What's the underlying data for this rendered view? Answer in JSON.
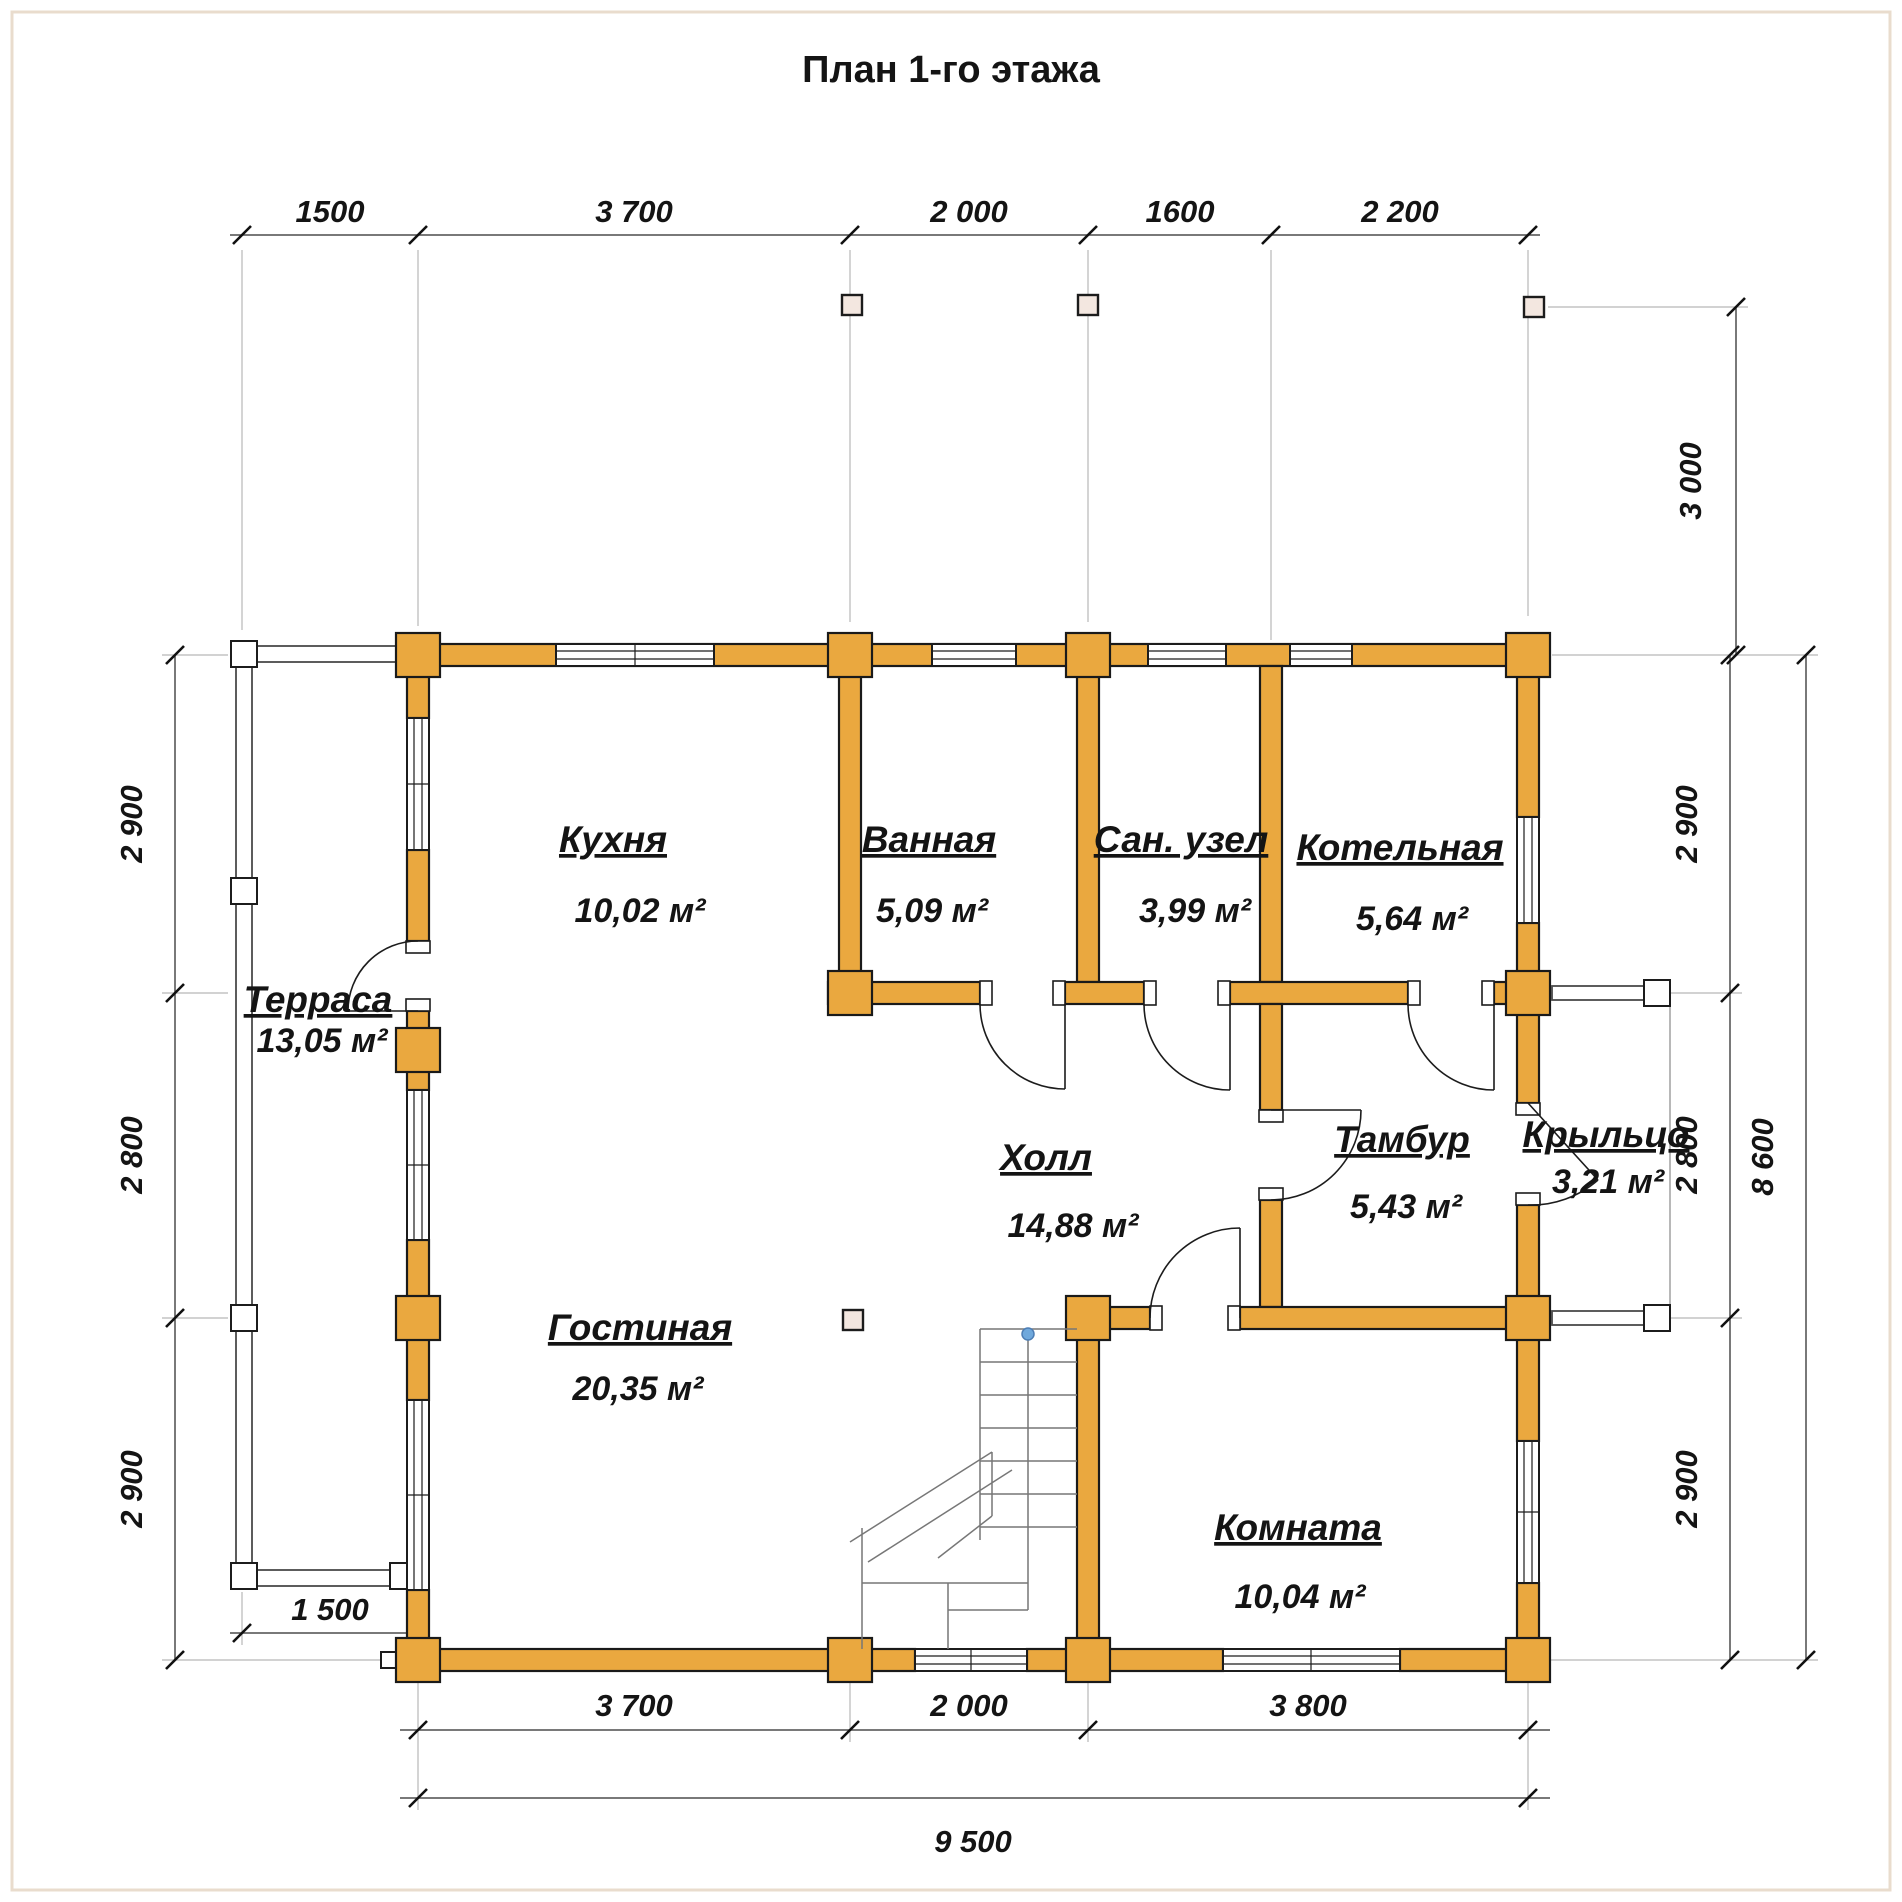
{
  "title": "План 1-го этажа",
  "colors": {
    "wall": "#EAA83F",
    "wall_outline": "#1A1A1A",
    "column_marker": "#F3E7E0",
    "dimension_line": "#4D4D4D",
    "text": "#141414",
    "stair_start_dot": "#6FA8DC"
  },
  "dims": {
    "top": {
      "d1": "1500",
      "d2": "3 700",
      "d3": "2 000",
      "d4": "1600",
      "d5": "2 200"
    },
    "right": {
      "d1": "3 000",
      "d2": "2 900",
      "d3": "2 800",
      "d4": "2 900",
      "d5": "8 600"
    },
    "left": {
      "d1": "2 900",
      "d2": "2 800",
      "d3": "2 900"
    },
    "bottom": {
      "d1": "1 500",
      "d2": "3 700",
      "d3": "2 000",
      "d4": "3 800",
      "d5": "9 500"
    }
  },
  "rooms": {
    "kitchen": {
      "name": "Кухня",
      "area": "10,02 м²"
    },
    "bathroom": {
      "name": "Ванная",
      "area": "5,09 м²"
    },
    "wc": {
      "name": "Сан. узел",
      "area": "3,99 м²"
    },
    "boiler": {
      "name": "Котельная",
      "area": "5,64 м²"
    },
    "terrace": {
      "name": "Терраса",
      "area": "13,05 м²"
    },
    "hall": {
      "name": "Холл",
      "area": "14,88 м²"
    },
    "tambour": {
      "name": "Тамбур",
      "area": "5,43 м²"
    },
    "porch": {
      "name": "Крыльцо",
      "area": "3,21 м²"
    },
    "living": {
      "name": "Гостиная",
      "area": "20,35 м²"
    },
    "room": {
      "name": "Комната",
      "area": "10,04 м²"
    }
  }
}
